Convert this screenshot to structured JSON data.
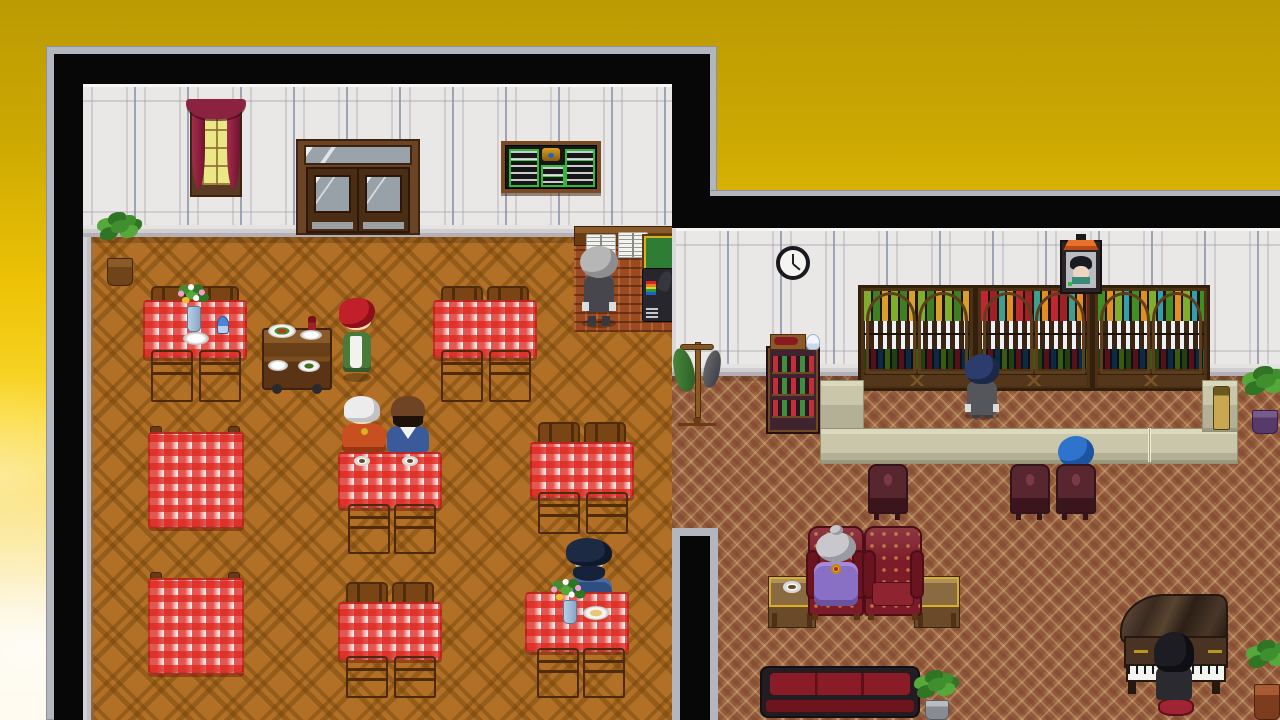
{
  "meta": {
    "domain": "Game",
    "description": "Top-down 16-bit style RPG interior screenshot (RPG Maker look): a restaurant dining room on the left and a bar lounge on the right, floating over a golden gradient sky background",
    "visible_text": "none (menu boards and books contain illegible pixel scribbles)"
  },
  "palette": {
    "sky-top": "#bb9a03",
    "sky-mid": "#eec307",
    "sky-low": "#fbd92f",
    "sky-cream": "#fdf7e8",
    "frame-gray": "#b3b7bd",
    "border-black": "#070707",
    "wall": "#eae8e6",
    "wall-line": "#9fa3b6",
    "baseboard": "#cfcdce",
    "floor-dining": "#b17026",
    "floor-lattice": "#6e400a",
    "carpet": "#9c6843",
    "carpet-motif": "#7a3e2c",
    "carpet-cream": "#f0cd96",
    "cloth-red": "#dd2820",
    "wood": "#7c4616",
    "wood-dark": "#4e2a0c",
    "counter-beige": "#c9c6aa",
    "cabinet-wood": "#4e3115",
    "armchair-red": "#7c1c28",
    "sofa-red": "#8a1c28",
    "curtain": "#8a2240",
    "glass-yellow": "#ece785",
    "door-wood": "#4a2d12",
    "piano-wood": "#3f2b1d",
    "gold": "#d8b020"
  },
  "scene": {
    "background": {
      "label": "golden-yellow vertical gradient sky with soft white clouds in the lower left"
    },
    "dining_room": {
      "label": "restaurant dining room",
      "walls": "white wainscot panels with blue-gray pilasters",
      "floor": "orange-brown parquet with large dark diamond lattice",
      "objects": [
        {
          "name": "curtained-window",
          "desc": "crimson curtains over yellow glass"
        },
        {
          "name": "double-door",
          "desc": "dark wood double door with glass panes and transom"
        },
        {
          "name": "menu-chalkboard",
          "desc": "wall menu board, green panels with white scribbles and gold emblem"
        },
        {
          "name": "potted-plant",
          "desc": "leafy plant in wicker pot, top-left corner"
        },
        {
          "name": "reception-counter",
          "desc": "wood counter with two open guest books"
        },
        {
          "name": "green-register-board",
          "desc": "small green board with gold frame"
        },
        {
          "name": "cash-register",
          "desc": "dark cash register with rainbow screen"
        },
        {
          "name": "serving-cart",
          "desc": "wooden cart with plates of food and a wine bottle"
        },
        {
          "name": "dining-tables",
          "desc": "9 tables with red-white gingham cloths and wooden chairs; one set with flower vase, plate and blue goblet; one with two coffee cups; one with flower vase and soup bowl"
        }
      ],
      "characters": [
        {
          "name": "waitress",
          "desc": "red-haired waitress in green uniform with white apron"
        },
        {
          "name": "butler",
          "desc": "gray-haired waiter in dark suit reading counter books, back turned"
        },
        {
          "name": "white-haired-man",
          "desc": "seated man with swept silver hair and orange-red cape with gold clasp"
        },
        {
          "name": "dark-skinned-man",
          "desc": "seated bald dark-skinned man with black beard in blue robe with white collar"
        },
        {
          "name": "bearded-man",
          "desc": "seated man with spiky navy hair and heavy beard in blue coat"
        }
      ]
    },
    "lounge_room": {
      "label": "bar lounge",
      "walls": "white wainscot panels",
      "floor": "red-brown patterned carpet with cream diamond lattice",
      "objects": [
        {
          "name": "wall-clock",
          "desc": "round black-rimmed clock"
        },
        {
          "name": "portrait",
          "desc": "framed portrait of a dark-haired man, orange pediment top"
        },
        {
          "name": "coat-rack",
          "desc": "wooden stand with green and gray coats"
        },
        {
          "name": "wine-cabinet",
          "desc": "dark display cabinet of red/green bottles, boxed wine bottle and glass on top"
        },
        {
          "name": "bar-back-cabinets",
          "desc": "three arched liquor cabinets: colored bottles, rows of white goblets, dark bottles"
        },
        {
          "name": "bar-counter",
          "desc": "U-shaped beige bar counter with service flap and a bottle on the right end"
        },
        {
          "name": "bar-stools",
          "desc": "three ornate dark-red stools"
        },
        {
          "name": "armchairs",
          "desc": "two tufted dark-red wingback armchairs"
        },
        {
          "name": "side-tables",
          "desc": "two gold-trimmed side tables, one with a coffee cup"
        },
        {
          "name": "sofa",
          "desc": "dark-red sofa with black frame"
        },
        {
          "name": "grand-piano",
          "desc": "brown grand piano with gold scrollwork and sheet music"
        },
        {
          "name": "potted-plants",
          "desc": "plants in silver, purple and terracotta pots"
        }
      ],
      "characters": [
        {
          "name": "bartender",
          "desc": "navy-haired bartender in gray suit behind the bar, back turned"
        },
        {
          "name": "blue-turban-patron",
          "desc": "patron with round blue turban seated at the bar"
        },
        {
          "name": "old-lady",
          "desc": "silver-haired elderly lady in purple dress with gold heart brooch, seated in armchair"
        },
        {
          "name": "pianist",
          "desc": "long black-haired pianist in dark coat on red stool playing the piano"
        }
      ]
    }
  }
}
